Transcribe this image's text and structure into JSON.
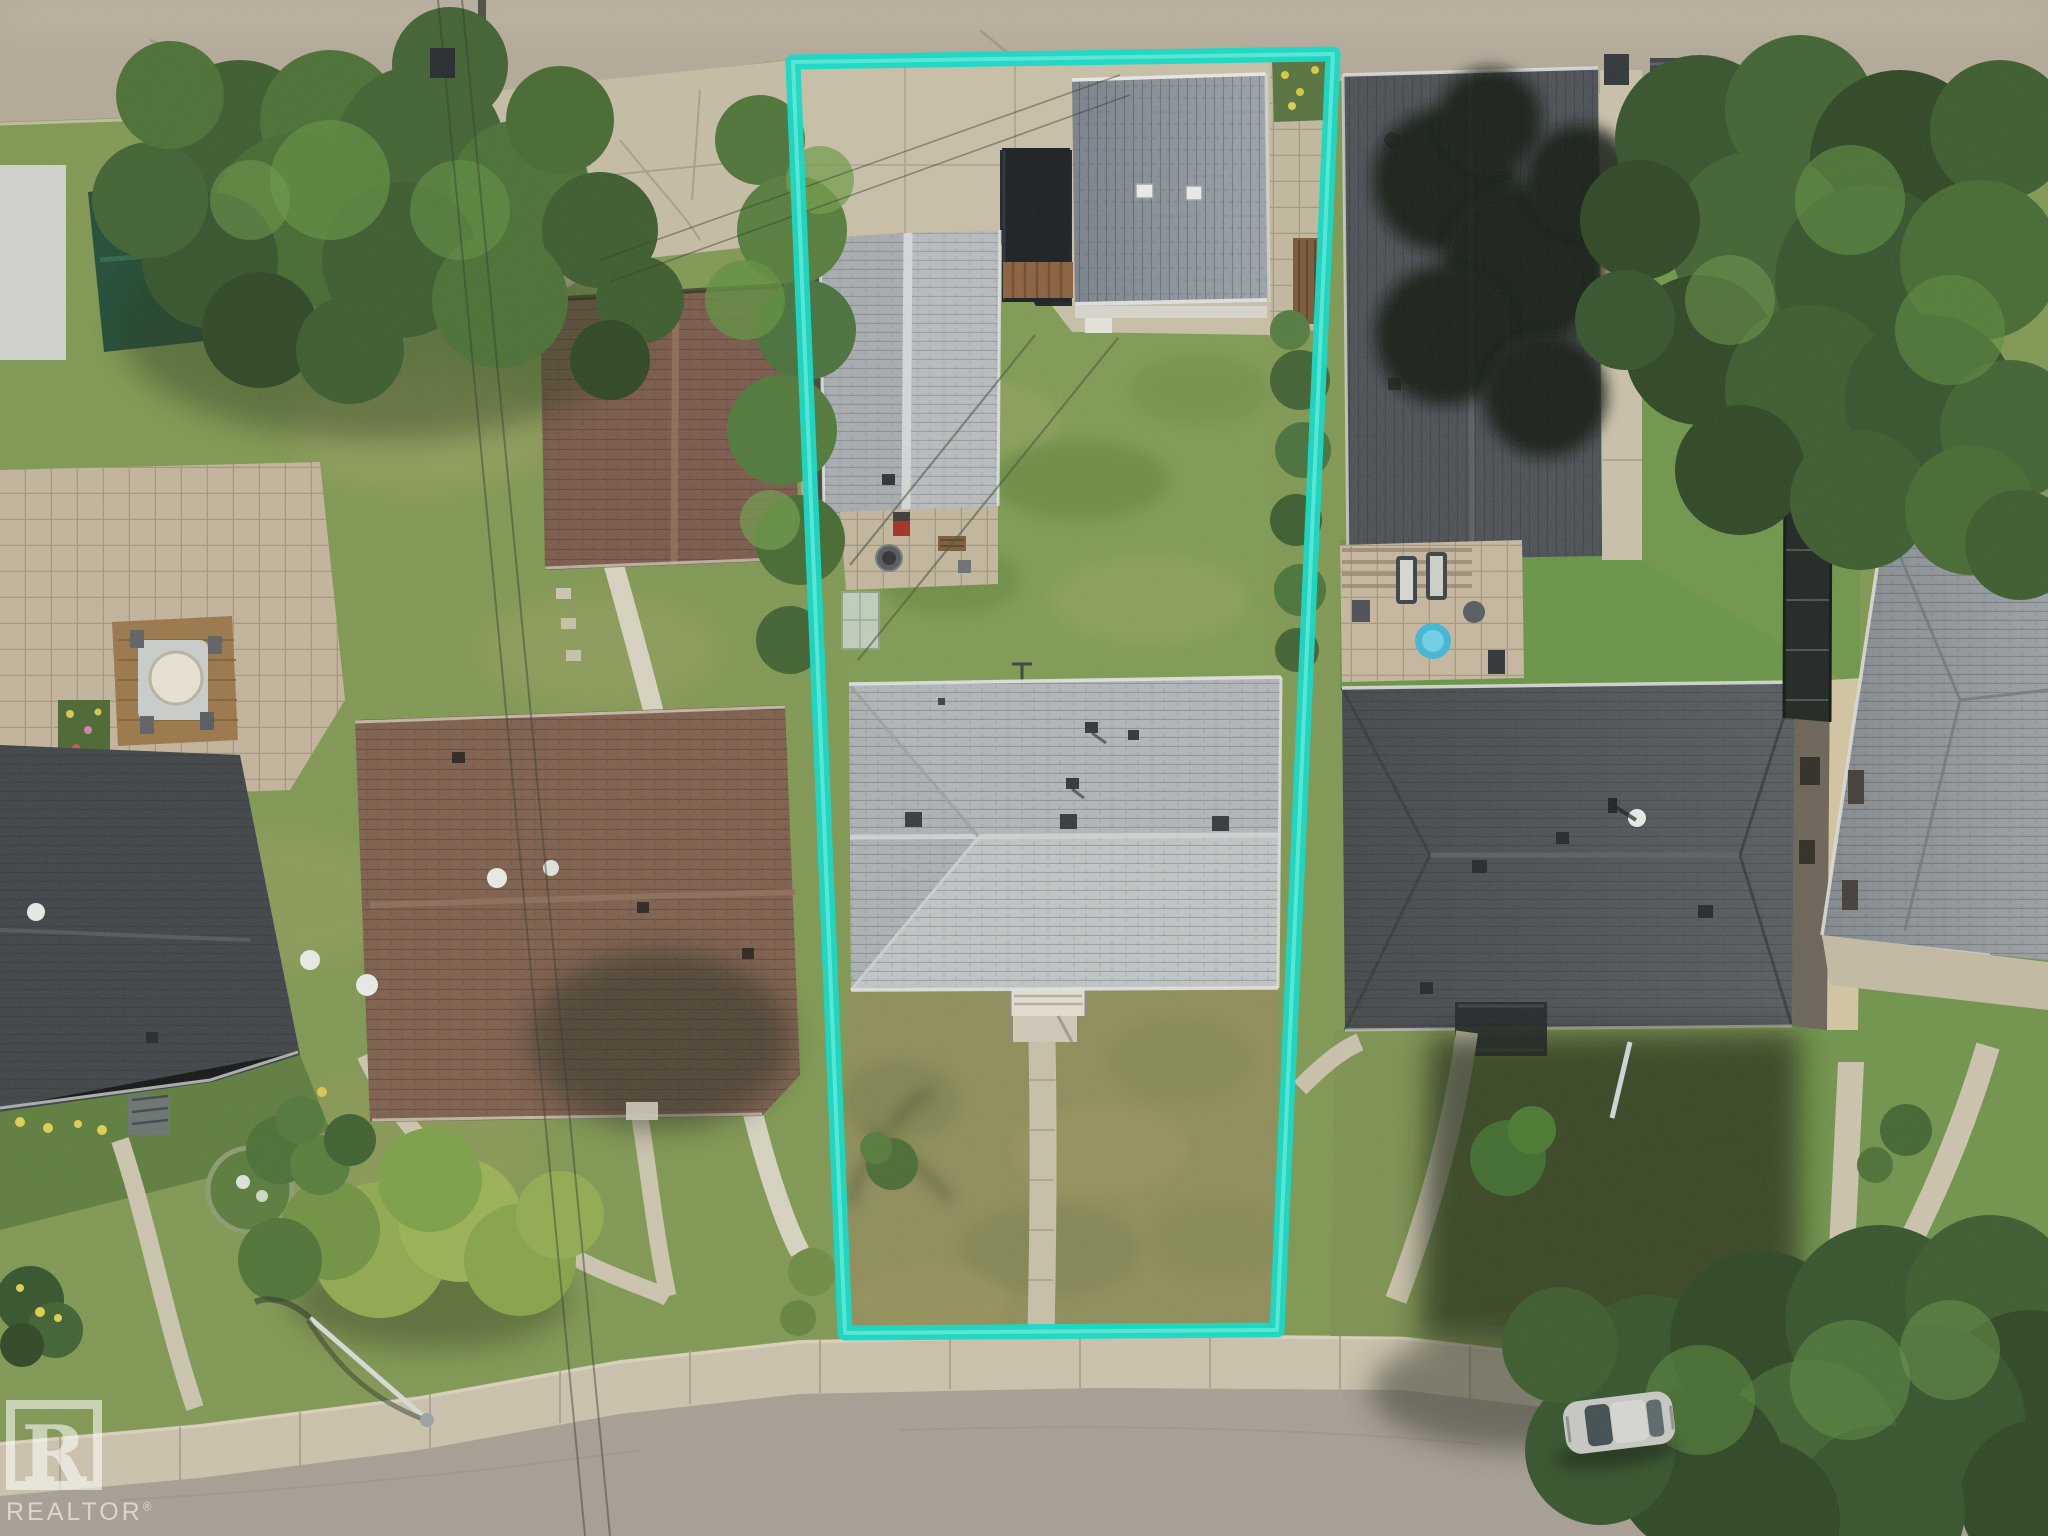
{
  "image": {
    "kind": "aerial-drone-photograph",
    "view": "top-down",
    "subject": "residential corner lot highlighted with a teal boundary outline, surrounded by neighbouring houses, yards, mature trees and two streets"
  },
  "watermark": {
    "label": "REALTOR",
    "registered": "®",
    "logo_letter": "R",
    "color": "#ffffff"
  },
  "property_outline": {
    "color": "#1cd8c5",
    "stroke_width": 15,
    "shape": "slightly skewed rectangle",
    "corners": {
      "top_left": [
        793,
        62
      ],
      "top_right": [
        1333,
        54
      ],
      "bottom_right": [
        1277,
        1330
      ],
      "bottom_left": [
        845,
        1333
      ]
    }
  },
  "palette": {
    "top_street": "#b3a998",
    "bottom_street": "#a79e93",
    "sidewalk": "#cbc2ac",
    "concrete_pad": "#c8bfa7",
    "subject_roof": "#bcc0c3",
    "garage_roof": "#89919a",
    "brown_roof": "#7d5e4c",
    "charcoal_roof": "#45494d",
    "lawn_green": "#7e9850",
    "lawn_olive": "#8e8c58",
    "tree_green": "#3a5a2c"
  },
  "scene": {
    "features": [
      {
        "name": "top-street",
        "description": "paved lane along the top edge"
      },
      {
        "name": "bottom-street",
        "description": "curving residential street with sidewalk along the bottom"
      },
      {
        "name": "subject-lot",
        "description": "deep narrow lot inside the teal outline"
      },
      {
        "name": "subject-house",
        "description": "light grey shingled bungalow with front steps and walkway"
      },
      {
        "name": "subject-garage",
        "description": "detached grey-roof garage on rear parking pad"
      },
      {
        "name": "subject-secondary-building",
        "description": "smaller grey gable-roof building beside the garage"
      },
      {
        "name": "backyard-lawn",
        "description": "green rear lawn of subject lot"
      },
      {
        "name": "front-lawn",
        "description": "dry olive front lawn with straight walkway"
      },
      {
        "name": "left-garage-brown",
        "description": "brown-roof garage with concrete driveway, upper left"
      },
      {
        "name": "left-house-brown",
        "description": "large brown-roof house with white roof vents, lower left"
      },
      {
        "name": "far-left-house",
        "description": "dark-roof house on far left edge with flower garden"
      },
      {
        "name": "deck-patio",
        "description": "backyard deck with round table and paver patio, far left"
      },
      {
        "name": "right-house-upper",
        "description": "charcoal-roof house upper right with patio, loungers and blue kiddie pool"
      },
      {
        "name": "right-house-lower",
        "description": "charcoal-roof house mid right with curved front walk and flagpole"
      },
      {
        "name": "far-right-house",
        "description": "large grey hip-roof house on right edge"
      },
      {
        "name": "trees",
        "description": "mature tree canopies top-left, top-right and bottom-right"
      },
      {
        "name": "parked-car",
        "description": "silver car parked at the curb bottom right"
      },
      {
        "name": "streetlight",
        "description": "street light with long shadow, bottom left"
      },
      {
        "name": "garbage-bins",
        "description": "dark waste bins at lane edge, top left and top right"
      }
    ]
  }
}
